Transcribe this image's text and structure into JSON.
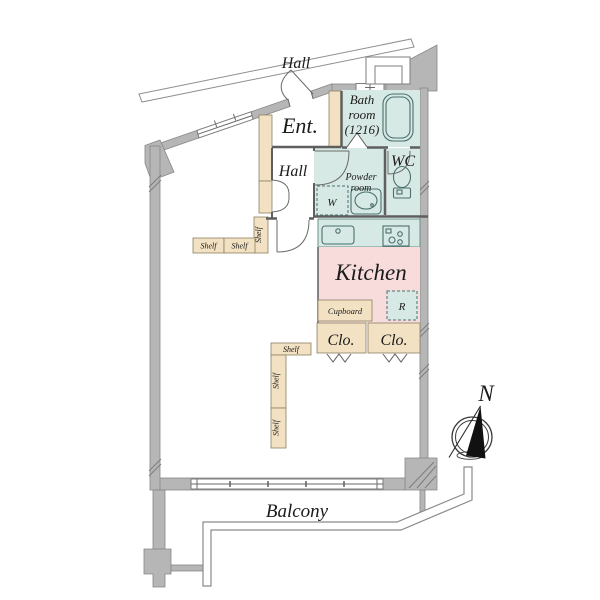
{
  "colors": {
    "wall_gray": "#b6b6b6",
    "room_cyan": "#d7e9e4",
    "kitchen_pink": "#f8dcdc",
    "wood_tan": "#f2e1c2",
    "line": "#5f5f5f"
  },
  "rooms": {
    "hall_top": "Hall",
    "entrance": "Ent.",
    "bathroom": {
      "line1": "Bath",
      "line2": "room",
      "line3": "(1216)"
    },
    "hall_inner": "Hall",
    "wc": "WC",
    "powder_room": {
      "line1": "Powder",
      "line2": "room"
    },
    "washer": "W",
    "kitchen": "Kitchen",
    "fridge": "R",
    "cupboard": "Cupboard",
    "closet_left": "Clo.",
    "closet_right": "Clo.",
    "balcony": "Balcony"
  },
  "shelves": [
    "Shelf",
    "Shelf",
    "Shelf",
    "Shelf",
    "Shelf",
    "Shelf"
  ],
  "compass": {
    "north": "N"
  }
}
